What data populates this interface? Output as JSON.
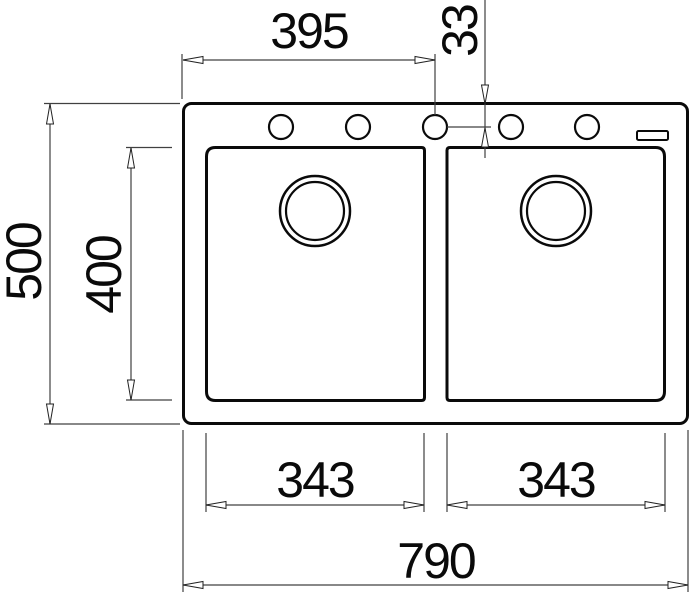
{
  "drawing": {
    "units": "mm",
    "stroke_color": "#0a0a0a",
    "background_color": "#ffffff",
    "labels": {
      "left_edge_to_center_hole": "395",
      "hole_offset_from_top": "33",
      "overall_depth": "500",
      "bowl_depth": "400",
      "left_bowl_width": "343",
      "right_bowl_width": "343",
      "overall_width": "790"
    },
    "features": {
      "faucet_hole_count": 5,
      "bowl_count": 2,
      "drain_count": 2
    }
  }
}
